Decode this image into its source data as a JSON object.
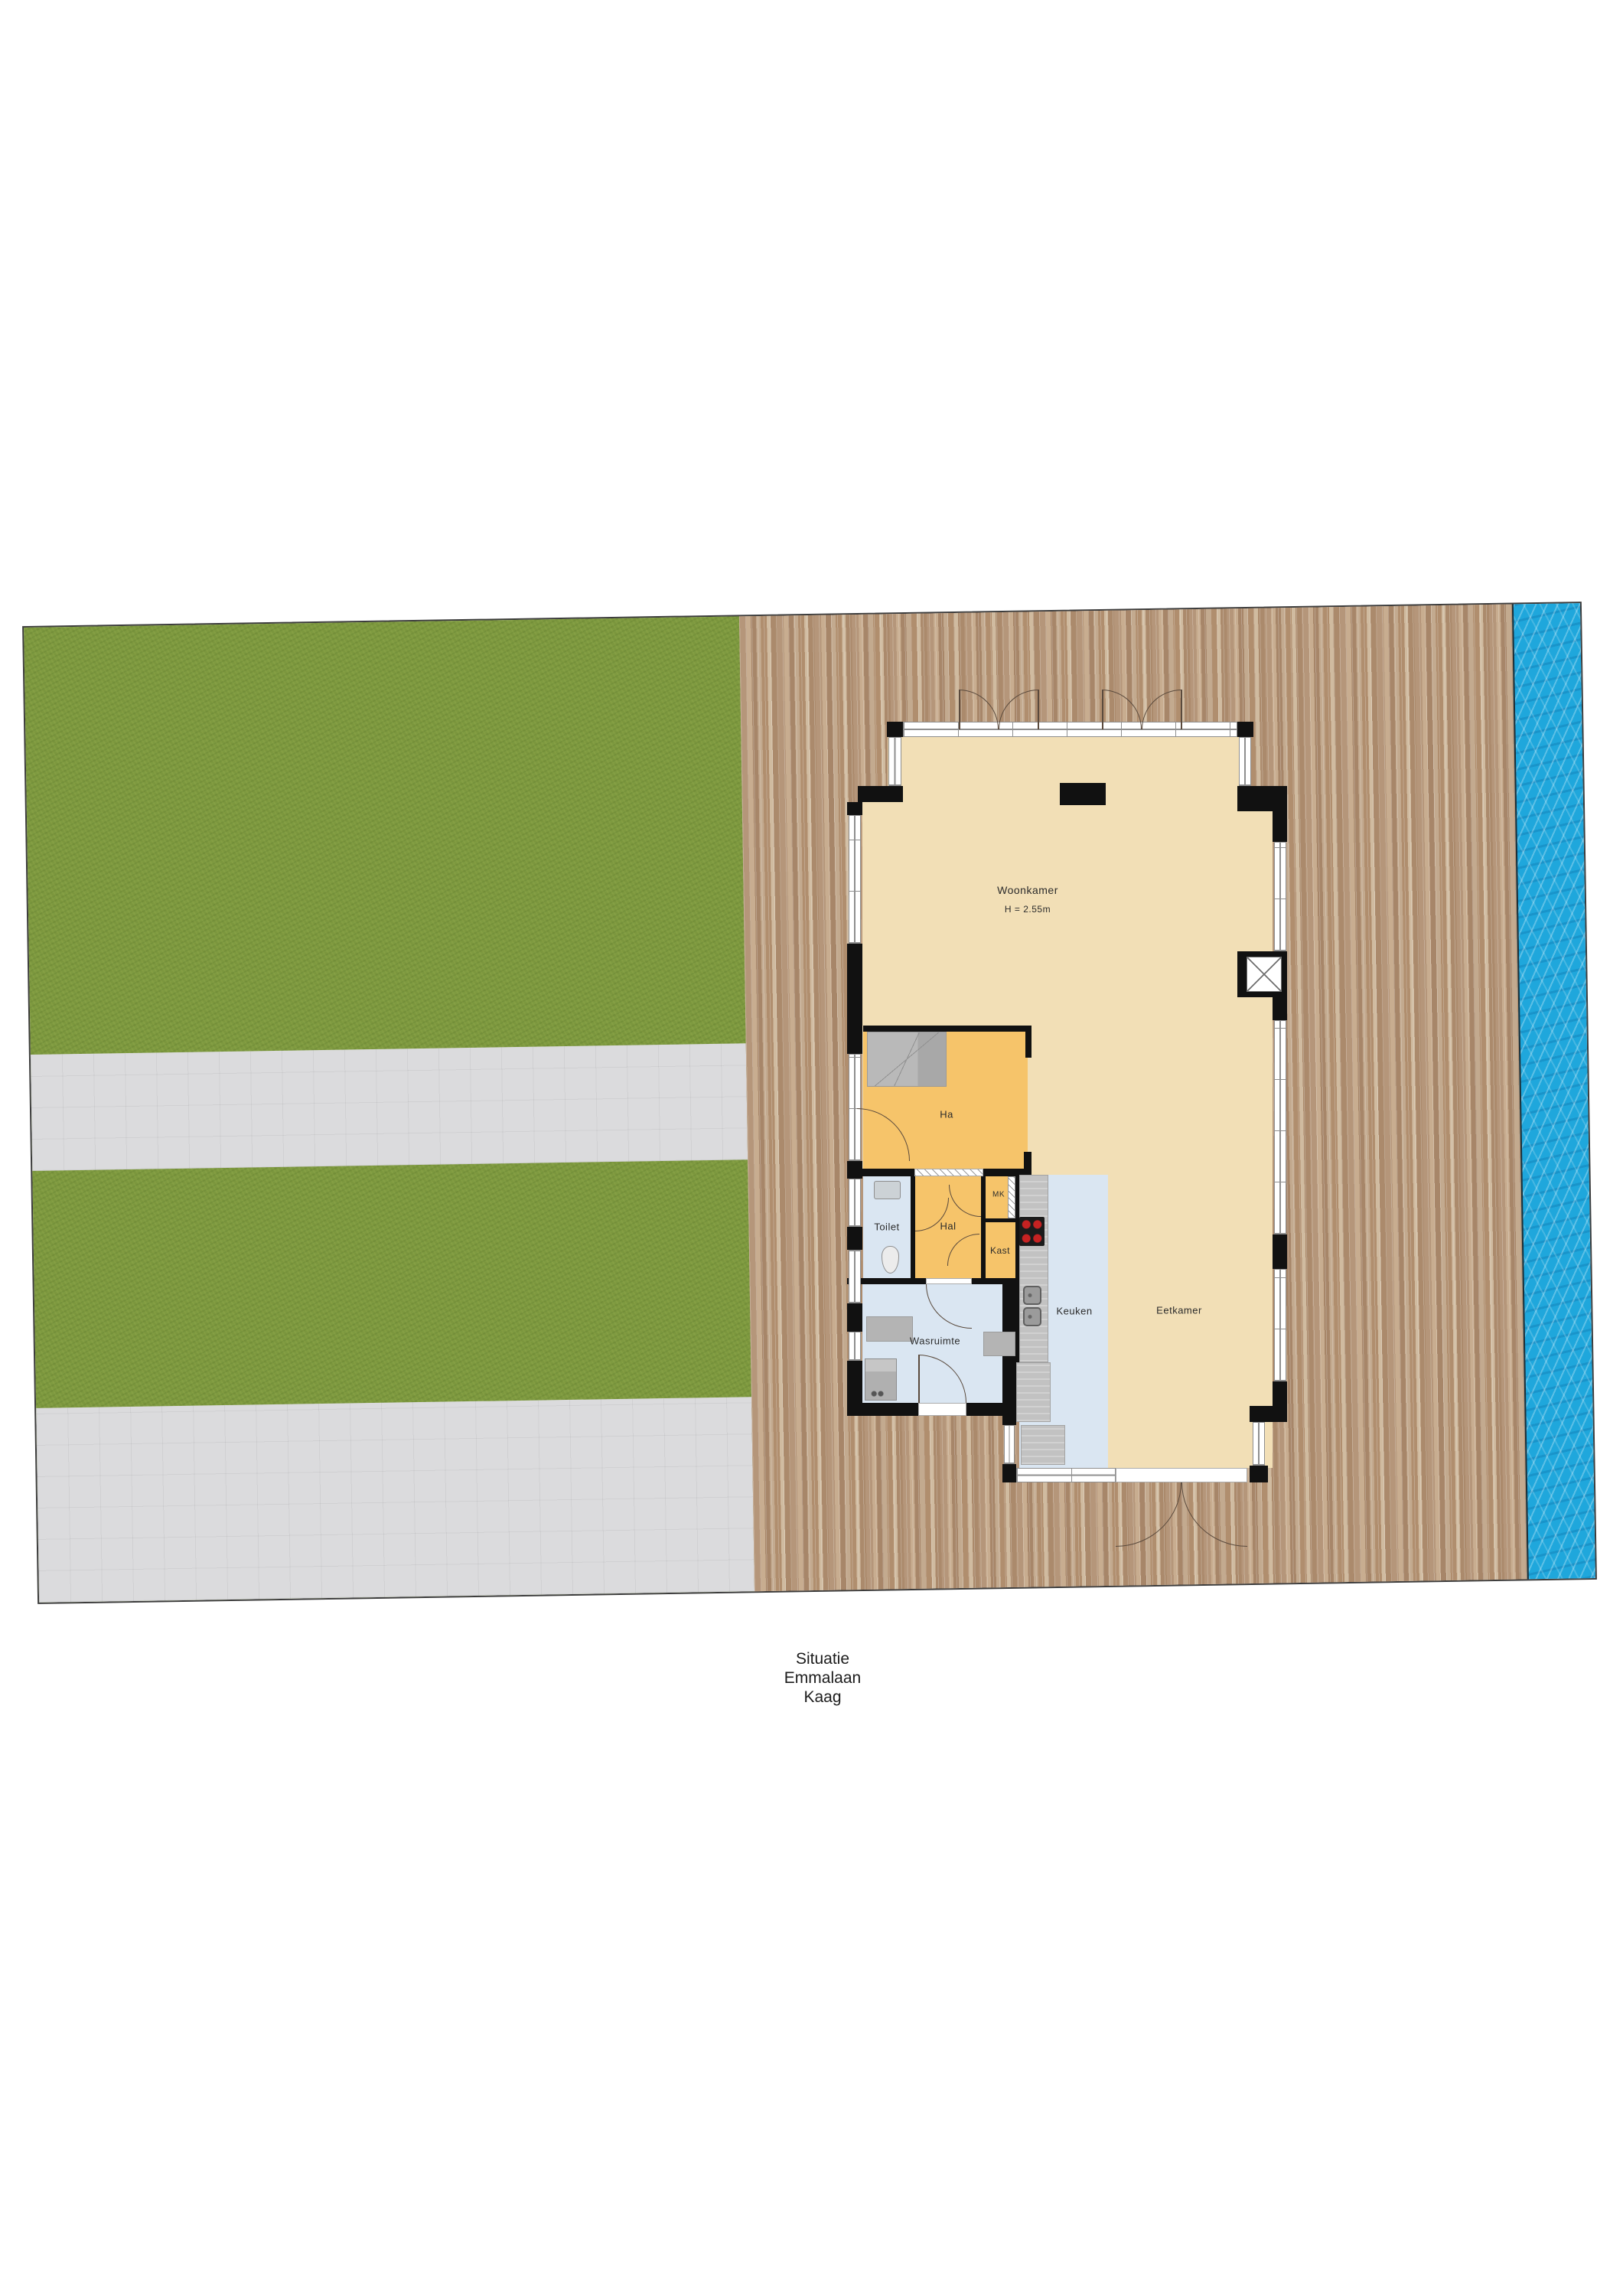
{
  "caption": {
    "lines": [
      "Situatie",
      "Emmalaan",
      "Kaag"
    ]
  },
  "rooms": {
    "woonkamer": {
      "label": "Woonkamer",
      "height_note": "H = 2.55m"
    },
    "ha": {
      "label": "Ha"
    },
    "toilet": {
      "label": "Toilet"
    },
    "hal": {
      "label": "Hal"
    },
    "mk": {
      "label": "MK"
    },
    "kast": {
      "label": "Kast"
    },
    "keuken": {
      "label": "Keuken"
    },
    "eetkamer": {
      "label": "Eetkamer"
    },
    "wasruimte": {
      "label": "Wasruimte"
    }
  },
  "colors": {
    "grass": "#7e9a40",
    "path": "#dbdbdd",
    "deck": "#bd9f82",
    "water": "#1fa7dc",
    "floor_tan": "#f2dfb6",
    "room_orange": "#f6c46a",
    "room_blue": "#dae6f2",
    "wall": "#111111",
    "window_line": "#8f8f8f",
    "burner_red": "#c62222"
  }
}
